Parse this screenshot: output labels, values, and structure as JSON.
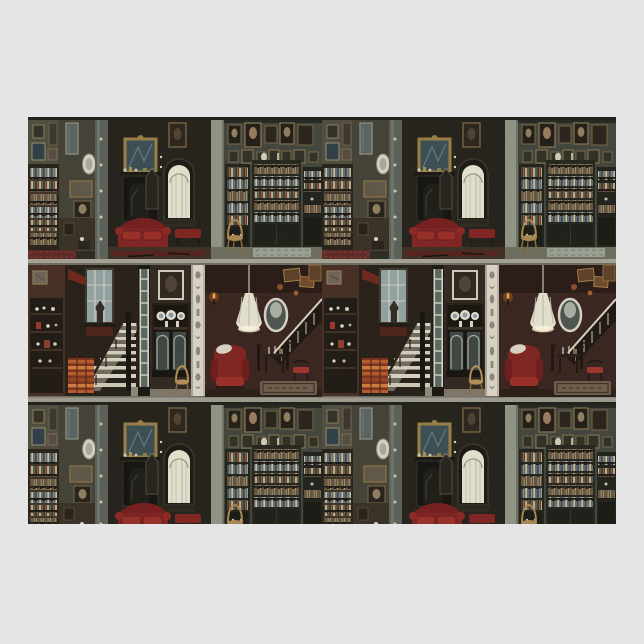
{
  "page": {
    "width": 644,
    "height": 644,
    "background_color": "#e5e5e5"
  },
  "artwork": {
    "type": "product-photo",
    "subject": "Victorian dollhouse interiors pattern wrapping paper sheet",
    "alt": "Flat wrapping paper sheet on a gray background, printed with a repeating pattern of dark Victorian dollhouse rooms: picture-covered walls with bookcases, a fireplace parlor with ornate mirror, red sofa and arched window, a library wall with portrait gallery, a staircase hall with tall window, a china display cabinet, a carved white column, and a gothic parlor with red wing chair, pendant lamp and oval mirror",
    "sheet": {
      "left": 28,
      "top": 117,
      "width": 588,
      "height": 407
    },
    "pattern": {
      "tile_width": 294,
      "tile_height": 285,
      "horizontal_repeats": 2,
      "rows": [
        {
          "name": "interior-row",
          "height": 142,
          "scenes": [
            "picture wall with bookcase",
            "fireplace parlor with red sofa and arched window",
            "library wall with portraits and bookcases"
          ]
        },
        {
          "name": "stair-hall-row",
          "height": 143,
          "scenes": [
            "etagere wall",
            "staircase hall with tall window and striped chest",
            "ladder-frame mirror",
            "china display cabinet",
            "carved white column",
            "gothic parlor with wing chair, pendant lamp, oval mirror and stair bannister"
          ]
        },
        {
          "name": "interior-row-cropped",
          "height": 122,
          "scenes": [
            "repeat of interior-row, bottom cropped"
          ]
        }
      ]
    }
  },
  "colors": {
    "page_bg": "#e5e5e5",
    "paper_base": "#28271f",
    "wall_olive": "#4a493b",
    "wall_dark": "#1f1d16",
    "wall_sage": "#8e9282",
    "wall_maroon": "#43291f",
    "parlor_maroon": "#35201a",
    "accent_red": "#7d1f1d",
    "accent_red_bright": "#962a22",
    "cream": "#e4e0ce",
    "gold": "#967c42",
    "wood_dark": "#1d1813",
    "floor_brown": "#3a2b1f",
    "rug_red": "#5b2321",
    "rug_pale": "#99a091",
    "stair_orange": "#b5572a",
    "band_gray": "#a2a093",
    "window_pane": "#8fa0a0",
    "column_white": "#d8d3c3"
  }
}
